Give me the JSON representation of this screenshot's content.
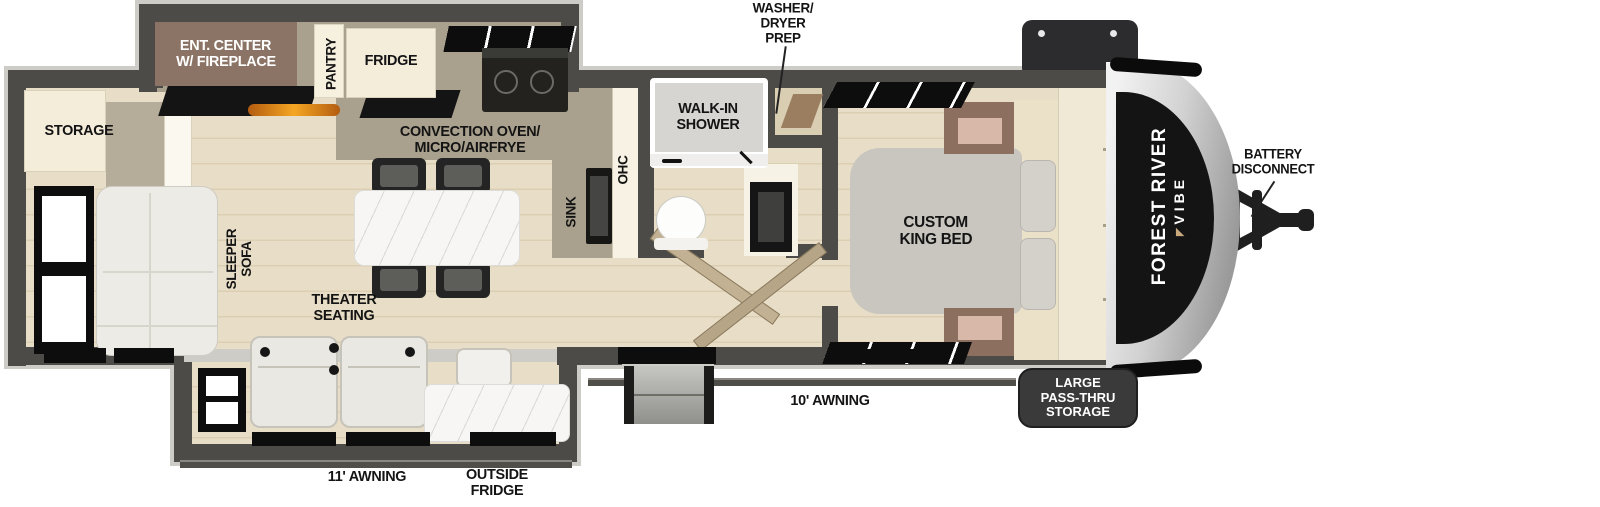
{
  "floorplan": {
    "title": "Forest River Vibe travel trailer floor plan",
    "labels": {
      "storage": "STORAGE",
      "ent_center": [
        "ENT. CENTER",
        "W/ FIREPLACE"
      ],
      "pantry": "PANTRY",
      "fridge": "FRIDGE",
      "convection": [
        "CONVECTION OVEN/",
        "MICRO/AIRFRYE"
      ],
      "washer_prep": [
        "WASHER/",
        "DRYER",
        "PREP"
      ],
      "walk_in_shower": [
        "WALK-IN",
        "SHOWER"
      ],
      "ohc": "OHC",
      "sink": "SINK",
      "sleeper_sofa": [
        "SLEEPER",
        "SOFA"
      ],
      "theater_seating": [
        "THEATER",
        "SEATING"
      ],
      "king_bed": [
        "CUSTOM",
        "KING BED"
      ],
      "awning_main": "10' AWNING",
      "awning_slide": "11' AWNING",
      "outside_fridge": [
        "OUTSIDE",
        "FRIDGE"
      ],
      "pass_thru": [
        "LARGE",
        "PASS-THRU",
        "STORAGE"
      ],
      "battery": [
        "BATTERY",
        "DISCONNECT"
      ],
      "brand": [
        "FOREST RIVER",
        "VIBE"
      ]
    },
    "colors": {
      "wall": "#4c4b47",
      "floor_wood": "#e8ddc6",
      "counter_taupe": "#a9a08d",
      "cabinet_cream": "#f4edda",
      "ent_center_brown": "#8b7465",
      "fireplace_orange": "#f5a623",
      "bed_gray": "#c9c6c0",
      "badge_dark": "#3a3a3a",
      "cap_black": "#141414"
    }
  }
}
